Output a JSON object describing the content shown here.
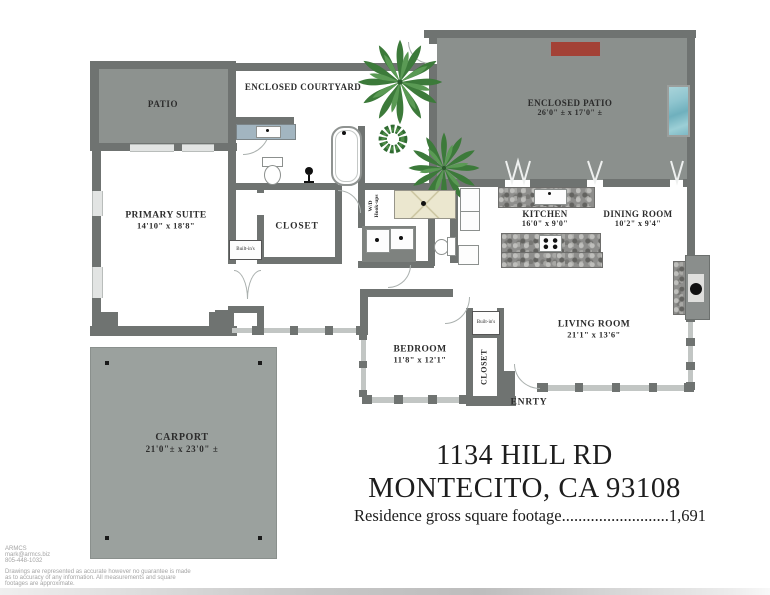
{
  "plan": {
    "rooms": {
      "patio": {
        "name": "PATIO"
      },
      "enclosed_courtyard": {
        "name": "ENCLOSED COURTYARD"
      },
      "enclosed_patio": {
        "name": "ENCLOSED PATIO",
        "dims": "26'0\" ± x 17'0\" ±"
      },
      "primary_suite": {
        "name": "PRIMARY SUITE",
        "dims": "14'10\" x 18'8\""
      },
      "primary_closet": {
        "name": "CLOSET"
      },
      "kitchen": {
        "name": "KITCHEN",
        "dims": "16'0\" x 9'0\""
      },
      "dining_room": {
        "name": "DINING ROOM",
        "dims": "10'2\" x 9'4\""
      },
      "living_room": {
        "name": "LIVING ROOM",
        "dims": "21'1\" x 13'6\""
      },
      "bedroom": {
        "name": "BEDROOM",
        "dims": "11'8\" x 12'1\""
      },
      "bedroom_closet": {
        "name": "CLOSET"
      },
      "carport": {
        "name": "CARPORT",
        "dims": "21'0\"± x 23'0\" ±"
      },
      "entry": {
        "name": "ENRTY"
      }
    },
    "annotations": {
      "builtins_primary": "Built-in's",
      "builtins_bedroom": "Built-in's",
      "wd_line1": "W/D",
      "wd_line2": "Hook-ups"
    }
  },
  "address": {
    "line1": "1134 HILL RD",
    "line2": "MONTECITO, CA 93108"
  },
  "footage": {
    "label": "Residence gross square footage",
    "dots": "..........................",
    "value": "1,691"
  },
  "footer": {
    "company": "ARMCS",
    "email": "mark@armcs.biz",
    "phone": "805-448-1032",
    "disclaimer1": "Drawings are represented as accurate however no guarantee is made",
    "disclaimer2": "as to accuracy of any information. All measurements and square",
    "disclaimer3": "footages are approximate."
  },
  "colors": {
    "wall": "#6f7371",
    "patio": "#8d928f",
    "enclosed_patio": "#8b908d",
    "carport": "#9ba19e",
    "grill_red": "#a34136",
    "water_blue": "#8fc5cf",
    "shower_tan": "#ebe7cf",
    "vanity_blue": "#a2b5c0",
    "plant_green": "#3c7a3a"
  }
}
